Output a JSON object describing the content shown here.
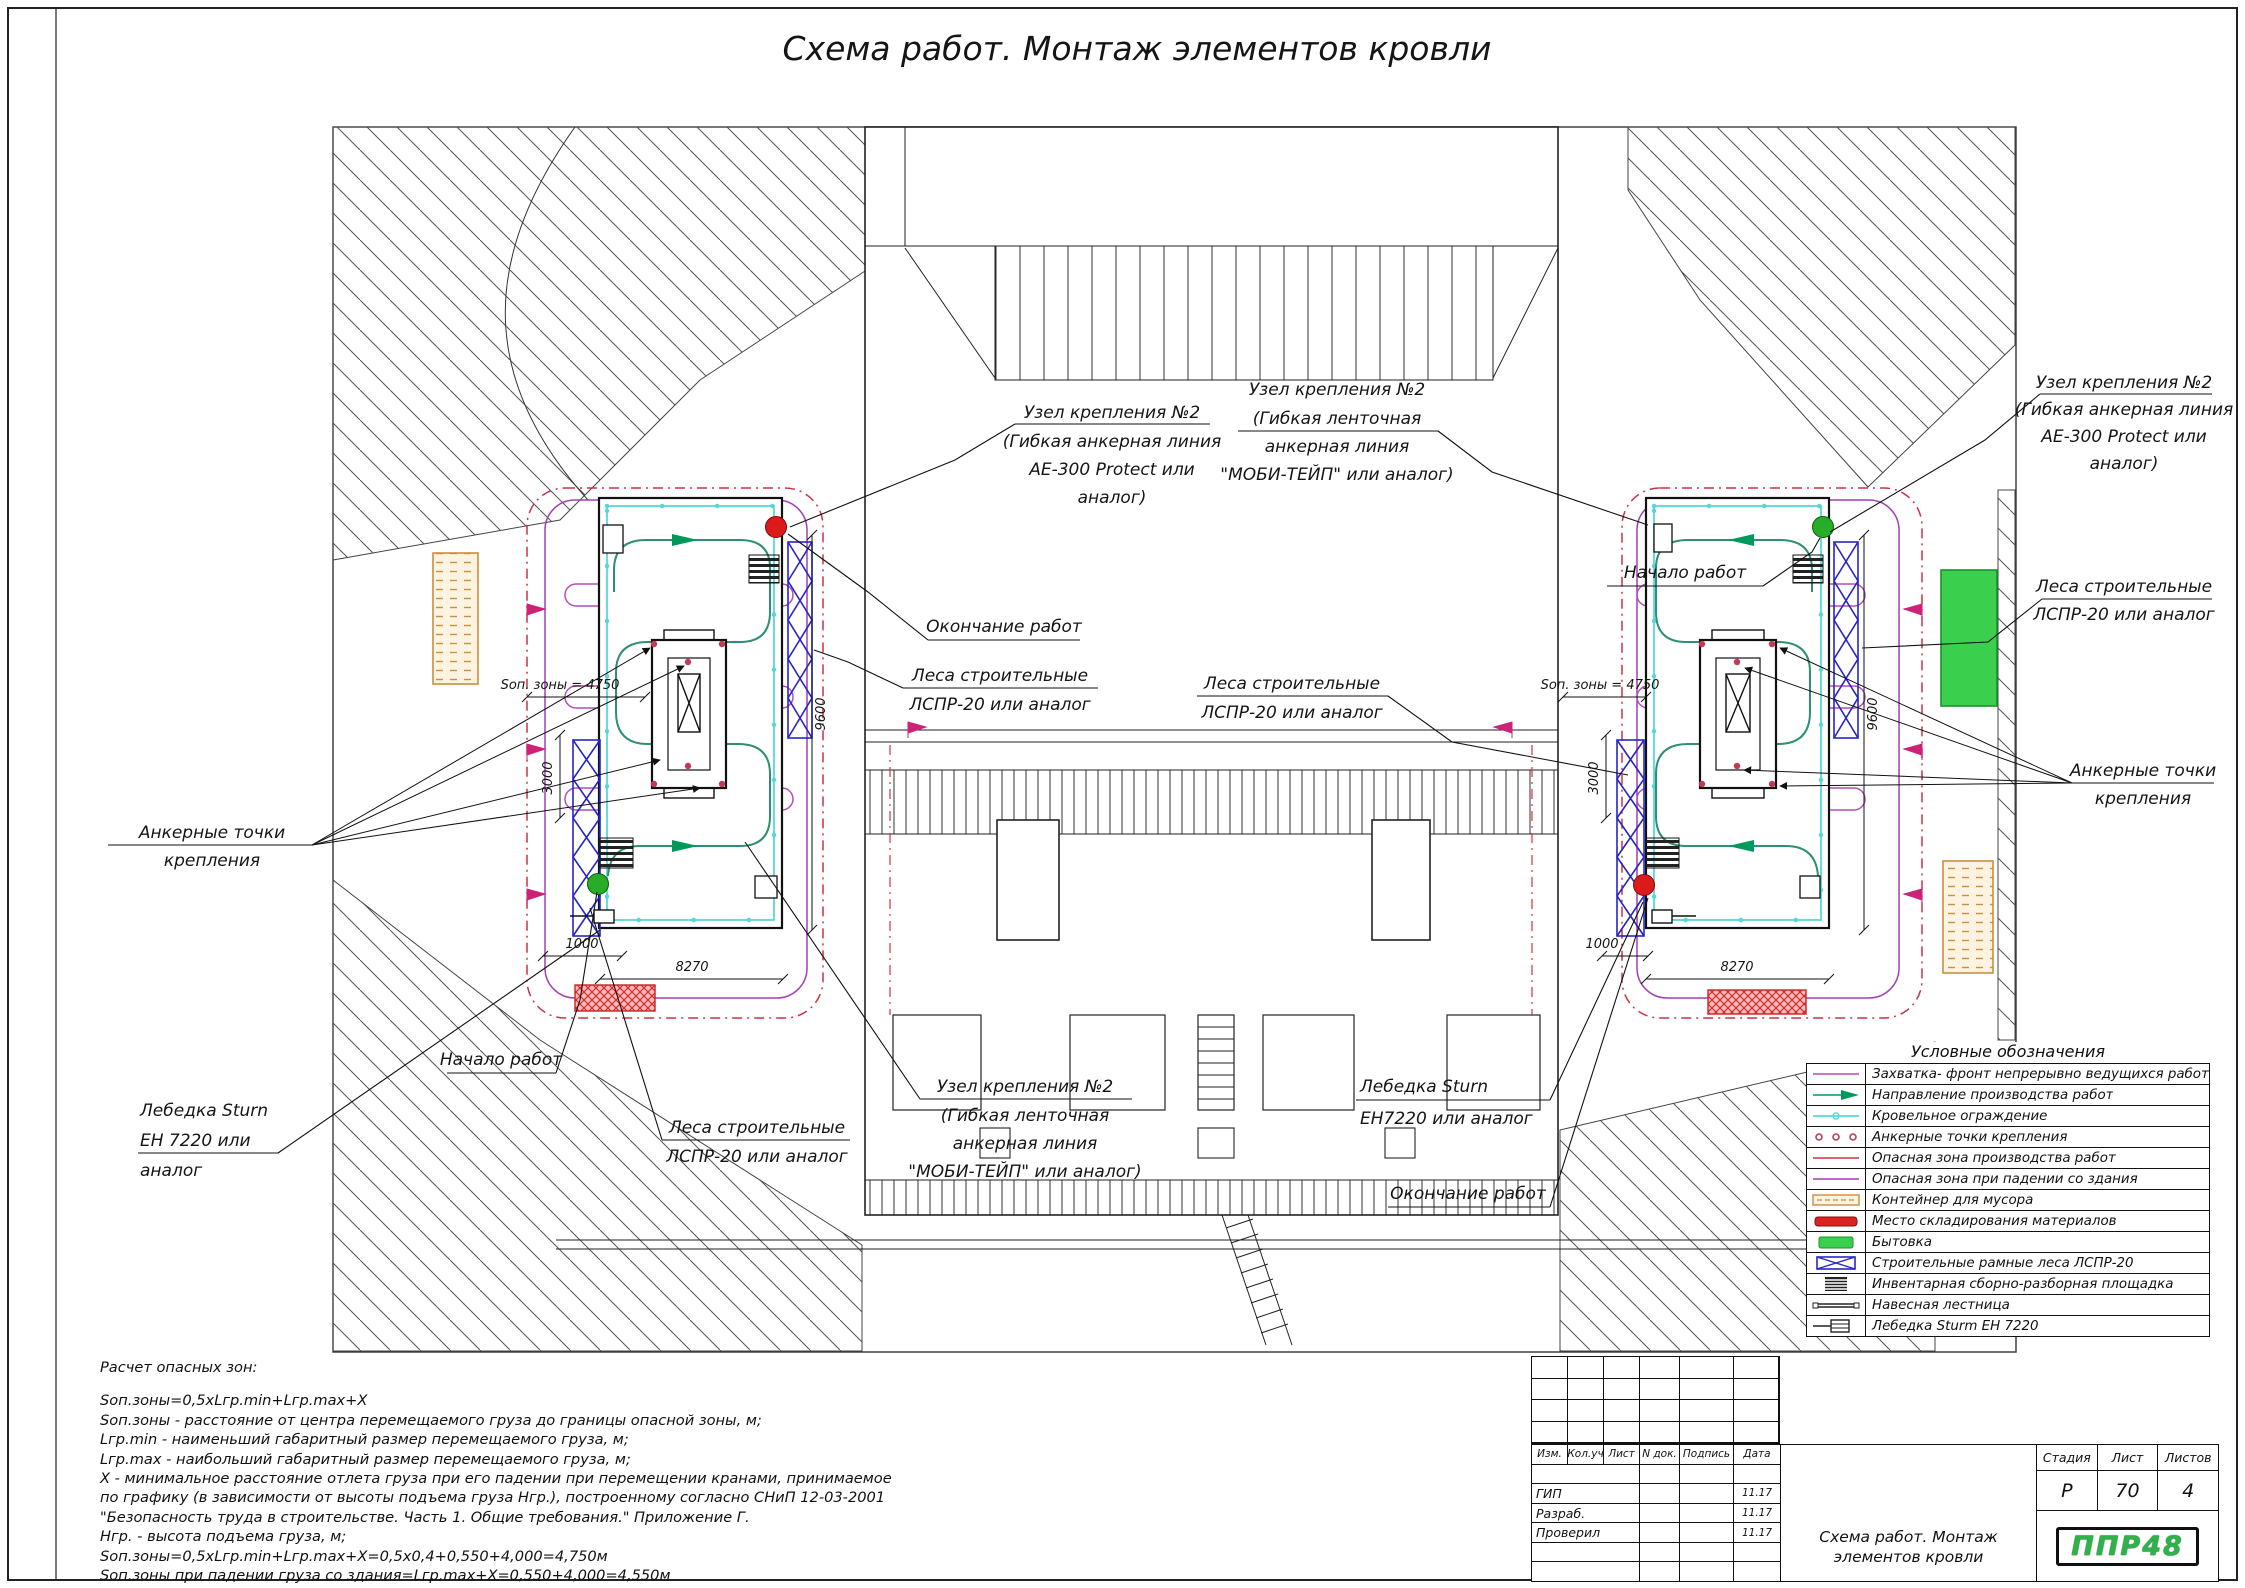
{
  "page": {
    "title": "Схема работ. Монтаж элементов кровли"
  },
  "callouts": {
    "uzel_ae300": {
      "l1": "Узел крепления  №2",
      "l2": "(Гибкая анкерная линия",
      "l3": "АЕ-300 Protect или",
      "l4": "аналог)"
    },
    "uzel_mobi": {
      "l1": "Узел крепления  №2",
      "l2": "(Гибкая ленточная",
      "l3": "анкерная линия",
      "l4": "\"МОБИ-ТЕЙП\" или аналог)"
    },
    "lesa": {
      "l1": "Леса строительные",
      "l2": "ЛСПР-20 или аналог"
    },
    "ankernye": {
      "l1": "Анкерные точки",
      "l2": "крепления"
    },
    "nachalo": "Начало работ",
    "okonchanie": "Окончание работ",
    "lebedka_left": {
      "l1": "Лебедка Sturn",
      "l2": "ЕН 7220 или",
      "l3": "аналог"
    },
    "lebedka_right": {
      "l1": "Лебедка Sturn",
      "l2": "ЕН7220 или аналог"
    }
  },
  "dims": {
    "sop": "Sоп. зоны = 4750",
    "w8270": "8270",
    "w1000": "1000",
    "h3000": "3000",
    "h9600": "9600"
  },
  "legend": {
    "title": "Условные обозначения",
    "items": [
      "Захватка- фронт непрерывно ведущихся работ",
      "Направление производства работ",
      "Кровельное ограждение",
      "Анкерные точки крепления",
      "Опасная зона производства работ",
      "Опасная зона при падении со здания",
      "Контейнер для мусора",
      "Место складирования материалов",
      "Бытовка",
      "Строительные рамные леса ЛСПР-20",
      "Инвентарная сборно-разборная площадка",
      "Навесная лестница",
      "Лебедка Sturm ЕН 7220"
    ]
  },
  "calc": {
    "heading": "Расчет опасных зон:",
    "lines": [
      "Sоп.зоны=0,5хLгр.min+Lгр.max+Х",
      "Sоп.зоны - расстояние от центра перемещаемого груза до границы опасной зоны, м;",
      "Lгр.min - наименьший габаритный размер перемещаемого груза, м;",
      "Lгр.max - наибольший габаритный размер перемещаемого груза, м;",
      "Х - минимальное расстояние отлета груза при его падении при перемещении кранами, принимаемое",
      "по графику (в зависимости от высоты подъема груза Нгр.), построенному согласно СНиП 12-03-2001",
      "\"Безопасность труда в строительстве. Часть 1. Общие требования.\" Приложение Г.",
      "Нгр. - высота подъема груза, м;",
      "Sоп.зоны=0,5хLгр.min+Lгр.max+Х=0,5х0,4+0,550+4,000=4,750м",
      "Sоп.зоны при падении груза со здания=Lгр.max+Х=0,550+4,000=4,550м"
    ]
  },
  "titleblock": {
    "cols": [
      "Изм.",
      "Кол.уч",
      "Лист",
      "N док.",
      "Подпись",
      "Дата"
    ],
    "rows": {
      "gip": "ГИП",
      "razrab": "Разраб.",
      "proveril": "Проверил"
    },
    "date": "11.17",
    "doc_title": "Схема работ. Монтаж элементов кровли",
    "stage_label": "Стадия",
    "sheet_label": "Лист",
    "sheets_label": "Листов",
    "stage": "Р",
    "sheet": "70",
    "sheets": "4",
    "logo": "ППР48"
  },
  "colors": {
    "zahvatka": "#b44fb4",
    "direction": "#00995c",
    "fence": "#57d8d8",
    "anchor": "#c23b55",
    "danger_work": "#cc3344",
    "danger_fall": "#a040b0",
    "container": "#c89040",
    "storage": "#dd2222",
    "bytovka": "#3ad04e",
    "scaffold": "#2724c8"
  }
}
